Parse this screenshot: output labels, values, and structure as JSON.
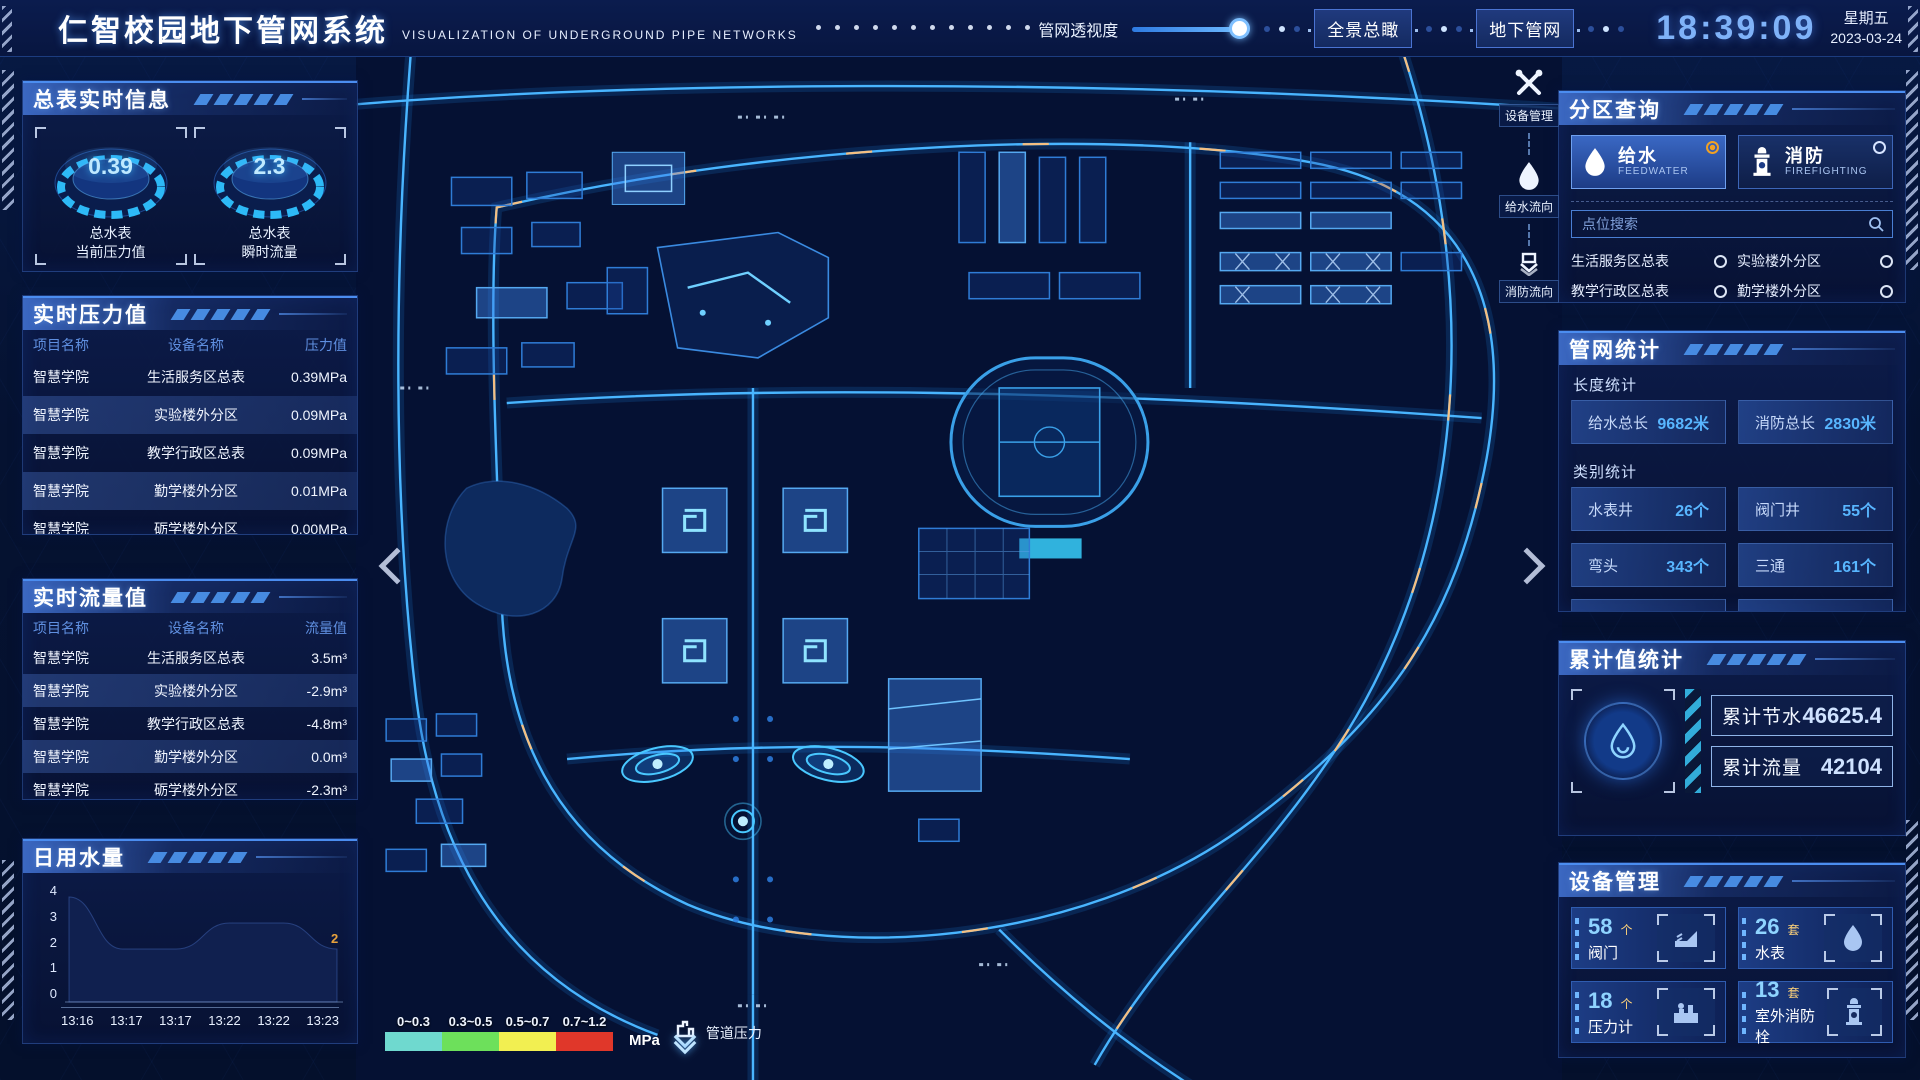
{
  "header": {
    "title": "仁智校园地下管网系统",
    "subtitle": "VISUALIZATION OF UNDERGROUND PIPE NETWORKS",
    "transparency_label": "管网透视度",
    "btn_overview": "全景总瞰",
    "btn_underground": "地下管网",
    "clock": "18:39:09",
    "weekday": "星期五",
    "date": "2023-03-24"
  },
  "left": {
    "meters": {
      "title": "总表实时信息",
      "gauges": [
        {
          "value": "0.39",
          "line1": "总水表",
          "line2": "当前压力值"
        },
        {
          "value": "2.3",
          "line1": "总水表",
          "line2": "瞬时流量"
        }
      ]
    },
    "pressure": {
      "title": "实时压力值",
      "headers": [
        "项目名称",
        "设备名称",
        "压力值"
      ],
      "rows": [
        [
          "智慧学院",
          "生活服务区总表",
          "0.39MPa"
        ],
        [
          "智慧学院",
          "实验楼外分区",
          "0.09MPa"
        ],
        [
          "智慧学院",
          "教学行政区总表",
          "0.09MPa"
        ],
        [
          "智慧学院",
          "勤学楼外分区",
          "0.01MPa"
        ],
        [
          "智慧学院",
          "砺学楼外分区",
          "0.00MPa"
        ]
      ]
    },
    "flow": {
      "title": "实时流量值",
      "headers": [
        "项目名称",
        "设备名称",
        "流量值"
      ],
      "rows": [
        [
          "智慧学院",
          "生活服务区总表",
          "3.5m³"
        ],
        [
          "智慧学院",
          "实验楼外分区",
          "-2.9m³"
        ],
        [
          "智慧学院",
          "教学行政区总表",
          "-4.8m³"
        ],
        [
          "智慧学院",
          "勤学楼外分区",
          "0.0m³"
        ],
        [
          "智慧学院",
          "砺学楼外分区",
          "-2.3m³"
        ]
      ]
    },
    "daily": {
      "title": "日用水量"
    }
  },
  "chart_data": {
    "type": "area",
    "title": "日用水量",
    "x": [
      "13:16",
      "13:17",
      "13:17",
      "13:22",
      "13:22",
      "13:23"
    ],
    "values": [
      4,
      2,
      2,
      3,
      3,
      2
    ],
    "y_ticks": [
      "4",
      "3",
      "2",
      "1",
      "0"
    ],
    "ylim": [
      0,
      4
    ],
    "end_label": "2",
    "grid": false,
    "legend_position": "none"
  },
  "map": {
    "tools": [
      {
        "label": "设备管理"
      },
      {
        "label": "给水流向"
      },
      {
        "label": "消防流向"
      }
    ],
    "legend": {
      "ranges": [
        {
          "label": "0~0.3",
          "color": "#6fd9cf"
        },
        {
          "label": "0.3~0.5",
          "color": "#6de05b"
        },
        {
          "label": "0.5~0.7",
          "color": "#f2ef51"
        },
        {
          "label": "0.7~1.2",
          "color": "#e0372a"
        }
      ],
      "unit": "MPa",
      "caption": "管道压力"
    }
  },
  "right": {
    "query": {
      "title": "分区查询",
      "toggles": [
        {
          "label": "给水",
          "sub": "FEEDWATER"
        },
        {
          "label": "消防",
          "sub": "FIREFIGHTING"
        }
      ],
      "search_placeholder": "点位搜索",
      "points": [
        "生活服务区总表",
        "实验楼外分区",
        "教学行政区总表",
        "勤学楼外分区",
        "砺学楼外分区",
        "宿舍区泵房"
      ]
    },
    "stats": {
      "title": "管网统计",
      "length_label": "长度统计",
      "length": [
        {
          "label": "给水总长",
          "value": "9682米"
        },
        {
          "label": "消防总长",
          "value": "2830米"
        }
      ],
      "category_label": "类别统计",
      "category": [
        {
          "label": "水表井",
          "value": "26个"
        },
        {
          "label": "阀门井",
          "value": "55个"
        },
        {
          "label": "弯头",
          "value": "343个"
        },
        {
          "label": "三通",
          "value": "161个"
        }
      ]
    },
    "cumulative": {
      "title": "累计值统计",
      "items": [
        {
          "label": "累计节水",
          "value": "46625.4"
        },
        {
          "label": "累计流量",
          "value": "42104"
        }
      ]
    },
    "devices": {
      "title": "设备管理",
      "cards": [
        {
          "count": "58",
          "unit": "个",
          "label": "阀门"
        },
        {
          "count": "26",
          "unit": "套",
          "label": "水表"
        },
        {
          "count": "18",
          "unit": "个",
          "label": "压力计"
        },
        {
          "count": "13",
          "unit": "套",
          "label": "室外消防栓"
        }
      ]
    }
  },
  "colors": {
    "accent": "#39c7f5",
    "selected_radio": "#f0a125"
  }
}
